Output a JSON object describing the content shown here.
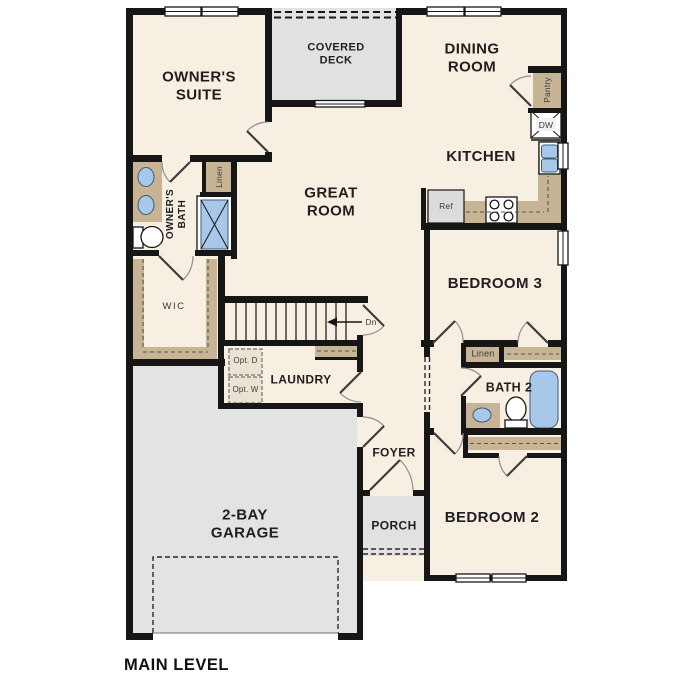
{
  "plan": {
    "level_title": "MAIN LEVEL"
  },
  "rooms": {
    "owners_suite": "OWNER'S SUITE",
    "covered_deck": "COVERED DECK",
    "dining_room": "DINING ROOM",
    "kitchen": "KITCHEN",
    "great_room": "GREAT ROOM",
    "owners_bath": "OWNER'S BATH",
    "wic": "WIC",
    "laundry": "LAUNDRY",
    "foyer": "FOYER",
    "porch": "PORCH",
    "garage": "2-BAY GARAGE",
    "bedroom3": "BEDROOM 3",
    "bedroom2": "BEDROOM 2",
    "bath2": "BATH 2"
  },
  "closets": {
    "linen_owners": "Linen",
    "linen_hall": "Linen",
    "pantry": "Pantry"
  },
  "appliances": {
    "dishwasher": "DW",
    "refrigerator": "Ref",
    "optional_dryer": "Opt. D",
    "optional_washer": "Opt. W"
  },
  "stairs": {
    "down_label": "Dn"
  },
  "colors": {
    "floor": "#f7efe1",
    "deck": "#e1e1e1",
    "garage": "#e3e3e3",
    "casework": "#c6b495",
    "fixture": "#a8c8ea",
    "wall": "#161616",
    "ink": "#1f1f1f"
  }
}
